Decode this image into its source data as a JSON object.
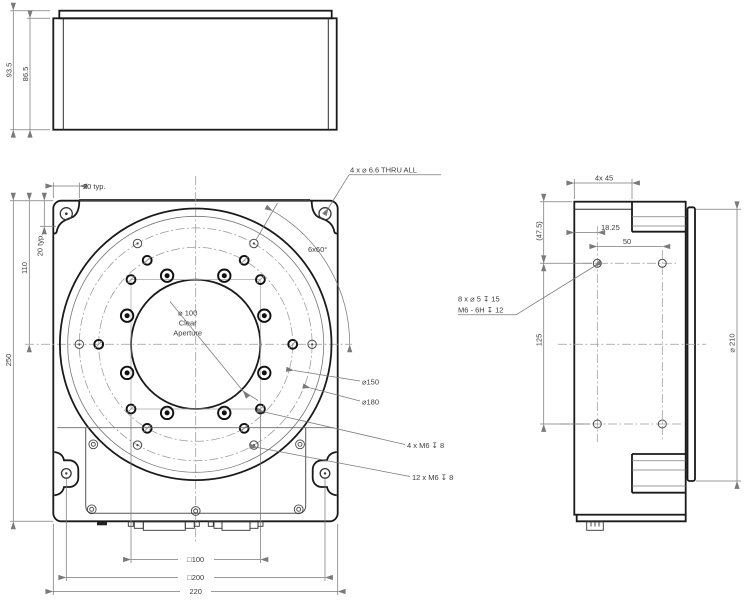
{
  "drawing": {
    "colors": {
      "ink": "#1a1a1a",
      "background": "#ffffff",
      "dim_line": "#7a7a7a"
    },
    "front_view": {
      "dim_total_height": "93.5",
      "dim_body_height": "86.5"
    },
    "plan_view": {
      "dim_corner_offset_h": "20 typ.",
      "dim_corner_offset_v": "20 typ.",
      "dim_center_from_top": "110",
      "dim_plate_height": "250",
      "label_corner_holes": "4 x ⌀ 6.6 THRU ALL",
      "label_hole_pattern_angle": "6x60°",
      "label_aperture_line1": "⌀ 100",
      "label_aperture_line2": "Clear",
      "label_aperture_line3": "Aperture",
      "label_bolt_circle_150": "⌀150",
      "label_bolt_circle_180": "⌀180",
      "label_m6_4": "4 x M6 ↧ 8",
      "label_m6_12": "12 x M6 ↧ 8",
      "dim_square_100": "□100",
      "dim_square_200": "□200",
      "dim_plate_width": "220"
    },
    "side_view": {
      "dim_top_step": "4x 45",
      "dim_hole_from_top": "(47.5)",
      "dim_hole_from_edge": "18.25",
      "dim_hole_spacing_h": "50",
      "dim_hole_spacing_v": "125",
      "label_side_holes_line1": "8 x ⌀ 5 ↧ 15",
      "label_side_holes_line2": "M6 - 6H ↧ 12",
      "dim_platform_dia": "⌀ 210"
    }
  }
}
